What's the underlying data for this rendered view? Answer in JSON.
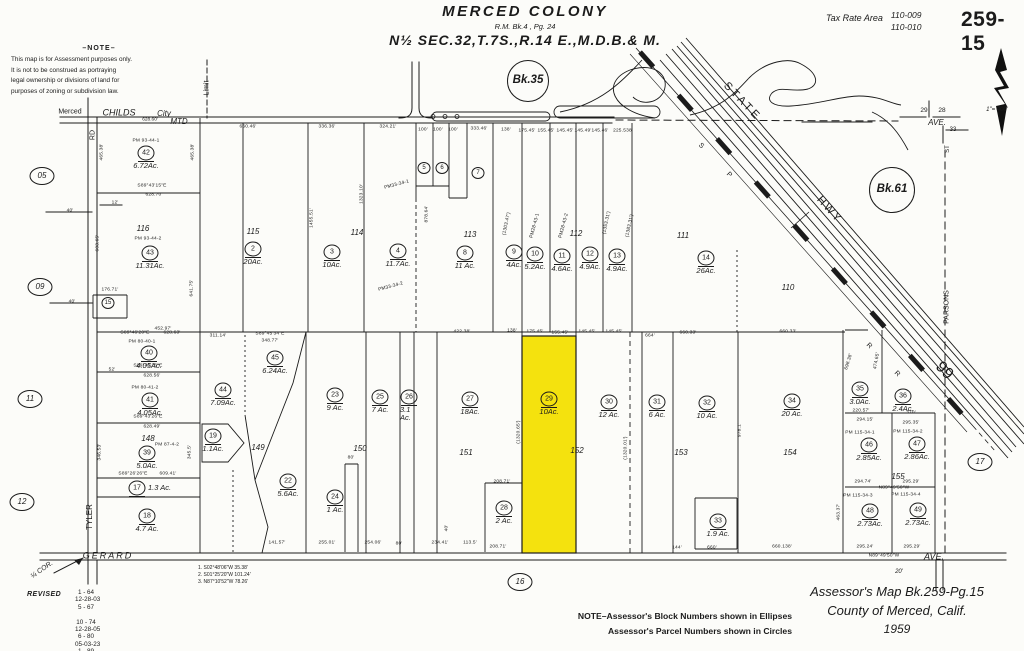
{
  "title": {
    "line1": "MERCED COLONY",
    "line2": "R.M. Bk.4 , Pg. 24",
    "line3": "N½ SEC.32,T.7S.,R.14 E.,M.D.B.& M."
  },
  "tax": {
    "label": "Tax Rate Area",
    "codes": [
      "110-009",
      "110-010"
    ]
  },
  "sheet_number": "259-15",
  "note_top_left": {
    "heading": "–NOTE–",
    "lines": [
      "This map is for Assessment purposes only.",
      "It is not to be construed as portraying",
      "legal ownership or divisions of land for",
      "purposes of zoning or subdivision law."
    ]
  },
  "legend_note": {
    "line1": "NOTE–Assessor's Block Numbers shown in Ellipses",
    "line2": "Assessor's Parcel Numbers shown in Circles"
  },
  "assessor_stamp": {
    "line1": "Assessor's Map Bk.259-Pg.15",
    "line2": "County of Merced, Calif.",
    "line3": "1959"
  },
  "revisions": {
    "label": "REVISED",
    "entries": [
      {
        "rev": "1 - 64",
        "date": "12-28-03"
      },
      {
        "rev": "5 - 67",
        "date": ""
      },
      {
        "rev": "10 - 74",
        "date": "12-28-05"
      },
      {
        "rev": "6 - 80",
        "date": "05-03-23"
      },
      {
        "rev": "1 - 89",
        "date": ""
      },
      {
        "rev": "11 - 91",
        "date": ""
      }
    ]
  },
  "bearing_table": [
    "1.  S02°48'06\"W   35.38'",
    "2.  S01°25'20\"W   101.24'",
    "3.  N87°10'52\"W   78.26'"
  ],
  "colors": {
    "highlight": "#F4E20E",
    "ink": "#1b1b1b",
    "paper": "#fcfcf9"
  },
  "parcels": [
    {
      "n": "42",
      "a": "6.72Ac.",
      "x": 146,
      "y": 153
    },
    {
      "n": "43",
      "a": "11.31Ac.",
      "x": 150,
      "y": 253
    },
    {
      "n": "15",
      "a": "",
      "x": 108,
      "y": 303,
      "small": true
    },
    {
      "n": "2",
      "a": "20Ac.",
      "x": 253,
      "y": 249
    },
    {
      "n": "3",
      "a": "10Ac.",
      "x": 332,
      "y": 252
    },
    {
      "n": "4",
      "a": "11.7Ac.",
      "x": 398,
      "y": 251
    },
    {
      "n": "5",
      "a": "",
      "x": 424,
      "y": 168,
      "small": true
    },
    {
      "n": "6",
      "a": "",
      "x": 442,
      "y": 168,
      "small": true
    },
    {
      "n": "7",
      "a": "",
      "x": 478,
      "y": 173,
      "small": true
    },
    {
      "n": "8",
      "a": "11 Ac.",
      "x": 465,
      "y": 253
    },
    {
      "n": "9",
      "a": "4Ac.",
      "x": 514,
      "y": 252
    },
    {
      "n": "10",
      "a": "5.2Ac.",
      "x": 535,
      "y": 254
    },
    {
      "n": "11",
      "a": "4.6Ac.",
      "x": 562,
      "y": 256
    },
    {
      "n": "12",
      "a": "4.9Ac.",
      "x": 590,
      "y": 254
    },
    {
      "n": "13",
      "a": "4.9Ac.",
      "x": 617,
      "y": 256
    },
    {
      "n": "14",
      "a": "26Ac.",
      "x": 706,
      "y": 258
    },
    {
      "n": "40",
      "a": "4.05Ac.",
      "x": 149,
      "y": 353
    },
    {
      "n": "41",
      "a": "4.05Ac.",
      "x": 150,
      "y": 400
    },
    {
      "n": "39",
      "a": "5.0Ac.",
      "x": 147,
      "y": 453
    },
    {
      "n": "45",
      "a": "6.24Ac.",
      "x": 275,
      "y": 358
    },
    {
      "n": "44",
      "a": "7.09Ac.",
      "x": 223,
      "y": 390
    },
    {
      "n": "19",
      "a": "1.1Ac.",
      "x": 213,
      "y": 436
    },
    {
      "n": "17",
      "a": "1.3 Ac.",
      "x": 137,
      "y": 488,
      "aside": true
    },
    {
      "n": "18",
      "a": "4.7 Ac.",
      "x": 147,
      "y": 516
    },
    {
      "n": "22",
      "a": "5.6Ac.",
      "x": 288,
      "y": 481
    },
    {
      "n": "23",
      "a": "9 Ac.",
      "x": 335,
      "y": 395
    },
    {
      "n": "24",
      "a": "1 Ac.",
      "x": 335,
      "y": 497
    },
    {
      "n": "25",
      "a": "7 Ac.",
      "x": 380,
      "y": 397
    },
    {
      "n": "26",
      "a": "3.1 Ac.",
      "x": 409,
      "y": 397,
      "wrap": true
    },
    {
      "n": "27",
      "a": "18Ac.",
      "x": 470,
      "y": 399
    },
    {
      "n": "28",
      "a": "2 Ac.",
      "x": 504,
      "y": 508
    },
    {
      "n": "29",
      "a": "10Ac.",
      "x": 549,
      "y": 399
    },
    {
      "n": "30",
      "a": "12 Ac.",
      "x": 609,
      "y": 402
    },
    {
      "n": "31",
      "a": "6 Ac.",
      "x": 657,
      "y": 402
    },
    {
      "n": "32",
      "a": "10 Ac.",
      "x": 707,
      "y": 403
    },
    {
      "n": "33",
      "a": "1.9 Ac.",
      "x": 718,
      "y": 521
    },
    {
      "n": "34",
      "a": "20 Ac.",
      "x": 792,
      "y": 401
    },
    {
      "n": "35",
      "a": "3.0Ac.",
      "x": 860,
      "y": 389
    },
    {
      "n": "36",
      "a": "2.4Ac.",
      "x": 903,
      "y": 396
    },
    {
      "n": "46",
      "a": "2.85Ac.",
      "x": 869,
      "y": 445
    },
    {
      "n": "47",
      "a": "2.86Ac.",
      "x": 917,
      "y": 444
    },
    {
      "n": "48",
      "a": "2.73Ac.",
      "x": 870,
      "y": 511
    },
    {
      "n": "49",
      "a": "2.73Ac.",
      "x": 918,
      "y": 510
    }
  ],
  "block_numbers": [
    {
      "t": "116",
      "x": 143,
      "y": 229
    },
    {
      "t": "115",
      "x": 253,
      "y": 232
    },
    {
      "t": "114",
      "x": 357,
      "y": 233
    },
    {
      "t": "113",
      "x": 470,
      "y": 235
    },
    {
      "t": "112",
      "x": 576,
      "y": 234
    },
    {
      "t": "111",
      "x": 683,
      "y": 236
    },
    {
      "t": "110",
      "x": 788,
      "y": 288
    },
    {
      "t": "148",
      "x": 148,
      "y": 439
    },
    {
      "t": "149",
      "x": 258,
      "y": 448
    },
    {
      "t": "150",
      "x": 360,
      "y": 449
    },
    {
      "t": "151",
      "x": 466,
      "y": 453
    },
    {
      "t": "152",
      "x": 577,
      "y": 451
    },
    {
      "t": "153",
      "x": 681,
      "y": 453
    },
    {
      "t": "154",
      "x": 790,
      "y": 453
    },
    {
      "t": "155",
      "x": 898,
      "y": 477
    }
  ],
  "block_ellipses": [
    {
      "t": "05",
      "x": 42,
      "y": 176
    },
    {
      "t": "09",
      "x": 40,
      "y": 287
    },
    {
      "t": "11",
      "x": 30,
      "y": 399
    },
    {
      "t": "12",
      "x": 22,
      "y": 502
    },
    {
      "t": "16",
      "x": 520,
      "y": 582
    },
    {
      "t": "17",
      "x": 980,
      "y": 462
    }
  ],
  "map_refs": [
    {
      "t": "Bk.35",
      "x": 528,
      "y": 81,
      "w": 40,
      "h": 40
    },
    {
      "t": "Bk.61",
      "x": 892,
      "y": 190,
      "w": 44,
      "h": 44
    }
  ],
  "road_labels": [
    {
      "t": "Merced",
      "x": 70,
      "y": 112,
      "s": 7,
      "nm": "merced-label"
    },
    {
      "t": "CHILDS",
      "x": 119,
      "y": 113,
      "s": 9,
      "i": 1,
      "nm": "childs-ave-label"
    },
    {
      "t": "City",
      "x": 164,
      "y": 114,
      "s": 8,
      "i": 1,
      "nm": "city-label"
    },
    {
      "t": "628.60'",
      "x": 150,
      "y": 121,
      "s": 4.8,
      "nm": "dim-childs"
    },
    {
      "t": "MTD",
      "x": 179,
      "y": 122,
      "s": 8,
      "i": 1,
      "nm": "mtd-label"
    },
    {
      "t": "Limit",
      "x": 207,
      "y": 88,
      "s": 7,
      "r": -90,
      "nm": "city-limit-label"
    },
    {
      "t": "RD",
      "x": 93,
      "y": 135,
      "s": 7,
      "r": -90,
      "nm": "rd-label"
    },
    {
      "t": "TYLER",
      "x": 90,
      "y": 517,
      "s": 8,
      "r": -90,
      "nm": "tyler-rd-label"
    },
    {
      "t": "GERARD",
      "x": 108,
      "y": 556,
      "s": 9,
      "ls": 2,
      "i": 1,
      "nm": "gerard-ave-label"
    },
    {
      "t": "AVE.",
      "x": 937,
      "y": 123,
      "s": 8,
      "i": 1,
      "nm": "ave-label-top"
    },
    {
      "t": "29",
      "x": 924,
      "y": 111,
      "s": 6.5,
      "nm": "section-number-label"
    },
    {
      "t": "28",
      "x": 942,
      "y": 111,
      "s": 6.5,
      "nm": "section-number-label"
    },
    {
      "t": "33",
      "x": 953,
      "y": 130,
      "s": 6,
      "nm": "section-number-label"
    },
    {
      "t": "ST",
      "x": 948,
      "y": 149,
      "s": 6,
      "r": -90,
      "nm": "st-label"
    },
    {
      "t": "PARSONS",
      "x": 947,
      "y": 307,
      "s": 7,
      "r": -90,
      "nm": "parsons-st-label"
    },
    {
      "t": "AVE.",
      "x": 934,
      "y": 557,
      "s": 9,
      "i": 1,
      "nm": "ave-label-bottom"
    },
    {
      "t": "20'",
      "x": 899,
      "y": 572,
      "s": 6,
      "i": 1,
      "nm": "dim-20ft"
    },
    {
      "t": "STATE",
      "x": 742,
      "y": 102,
      "s": 11,
      "r": 46,
      "ls": 3,
      "nm": "state-hwy-label-state"
    },
    {
      "t": "HWY",
      "x": 829,
      "y": 210,
      "s": 11,
      "r": 48,
      "ls": 2,
      "nm": "state-hwy-label-hwy"
    },
    {
      "t": "99",
      "x": 944,
      "y": 371,
      "s": 16,
      "r": 45,
      "nm": "state-hwy-label-99"
    },
    {
      "t": "S",
      "x": 701,
      "y": 146,
      "s": 7,
      "r": 45,
      "nm": "railroad-letter"
    },
    {
      "t": "P",
      "x": 729,
      "y": 175,
      "s": 7,
      "r": 45,
      "nm": "railroad-letter"
    },
    {
      "t": "R",
      "x": 869,
      "y": 346,
      "s": 7,
      "r": 45,
      "nm": "railroad-letter"
    },
    {
      "t": "R",
      "x": 897,
      "y": 374,
      "s": 7,
      "r": 45,
      "nm": "railroad-letter"
    },
    {
      "t": "¼ COR.",
      "x": 42,
      "y": 570,
      "s": 7,
      "r": -35,
      "i": 1,
      "nm": "quarter-corner-label"
    },
    {
      "t": "1\"= 400'",
      "x": 997,
      "y": 110,
      "s": 6,
      "i": 1,
      "nm": "scale-label"
    }
  ],
  "dimensions": [
    {
      "t": "660.46'",
      "x": 248,
      "y": 128
    },
    {
      "t": "336.36'",
      "x": 327,
      "y": 128
    },
    {
      "t": "324.21'",
      "x": 388,
      "y": 128
    },
    {
      "t": "100'",
      "x": 423,
      "y": 131
    },
    {
      "t": "100'",
      "x": 438,
      "y": 131
    },
    {
      "t": "100'",
      "x": 453,
      "y": 131
    },
    {
      "t": "333.46'",
      "x": 479,
      "y": 130
    },
    {
      "t": "138'",
      "x": 506,
      "y": 131
    },
    {
      "t": "175.45'",
      "x": 527,
      "y": 132
    },
    {
      "t": "155.45'",
      "x": 546,
      "y": 132
    },
    {
      "t": "145.45'",
      "x": 565,
      "y": 132
    },
    {
      "t": "145.49'",
      "x": 583,
      "y": 132
    },
    {
      "t": "145.46'",
      "x": 600,
      "y": 132
    },
    {
      "t": "225.538'",
      "x": 623,
      "y": 132
    },
    {
      "t": "465.38'",
      "x": 103,
      "y": 152,
      "r": -90
    },
    {
      "t": "465.38'",
      "x": 194,
      "y": 152,
      "r": -90
    },
    {
      "t": "603.65'",
      "x": 99,
      "y": 243,
      "r": -90
    },
    {
      "t": "641.75'",
      "x": 193,
      "y": 288,
      "r": -90
    },
    {
      "t": "S89°43'15\"E",
      "x": 152,
      "y": 187
    },
    {
      "t": "628.70'",
      "x": 154,
      "y": 196
    },
    {
      "t": "PM 93-44-1",
      "x": 146,
      "y": 142
    },
    {
      "t": "PM 93-44-2",
      "x": 148,
      "y": 240
    },
    {
      "t": "176.71'",
      "x": 110,
      "y": 291
    },
    {
      "t": "40'",
      "x": 72,
      "y": 303
    },
    {
      "t": "40'",
      "x": 70,
      "y": 212
    },
    {
      "t": "12'",
      "x": 115,
      "y": 204
    },
    {
      "t": "1455.51'",
      "x": 313,
      "y": 218,
      "r": -90
    },
    {
      "t": "1323.10'",
      "x": 363,
      "y": 194,
      "r": -90
    },
    {
      "t": "878.64'",
      "x": 428,
      "y": 214,
      "r": -90
    },
    {
      "t": "PM33-34-1",
      "x": 397,
      "y": 186,
      "r": -15
    },
    {
      "t": "PM33-34-2",
      "x": 391,
      "y": 288,
      "r": -15
    },
    {
      "t": "(1303.47')",
      "x": 508,
      "y": 224,
      "r": -78
    },
    {
      "t": "PM28-43-1",
      "x": 536,
      "y": 226,
      "r": -75
    },
    {
      "t": "PM28-43-2",
      "x": 565,
      "y": 226,
      "r": -75
    },
    {
      "t": "(1353.31')",
      "x": 608,
      "y": 223,
      "r": -78
    },
    {
      "t": "(1383.31')",
      "x": 631,
      "y": 226,
      "r": -78
    },
    {
      "t": "452.97'",
      "x": 163,
      "y": 330
    },
    {
      "t": "311.14'",
      "x": 218,
      "y": 337
    },
    {
      "t": "S89°45'34\"E",
      "x": 270,
      "y": 335
    },
    {
      "t": "348.77'",
      "x": 270,
      "y": 342
    },
    {
      "t": "422.38'",
      "x": 462,
      "y": 333
    },
    {
      "t": "138'",
      "x": 512,
      "y": 332
    },
    {
      "t": "175.45'",
      "x": 535,
      "y": 333
    },
    {
      "t": "155.45'",
      "x": 560,
      "y": 334
    },
    {
      "t": "145.45'",
      "x": 587,
      "y": 333
    },
    {
      "t": "145.45'",
      "x": 614,
      "y": 333
    },
    {
      "t": "664'",
      "x": 650,
      "y": 337
    },
    {
      "t": "660.33'",
      "x": 688,
      "y": 334
    },
    {
      "t": "660.33'",
      "x": 788,
      "y": 333
    },
    {
      "t": "S89°46'20\"E",
      "x": 135,
      "y": 334
    },
    {
      "t": "628.63'",
      "x": 172,
      "y": 334
    },
    {
      "t": "S89°45'26\"E",
      "x": 148,
      "y": 367
    },
    {
      "t": "628.56'",
      "x": 152,
      "y": 377
    },
    {
      "t": "S89°43'26\"E",
      "x": 148,
      "y": 418
    },
    {
      "t": "628.49'",
      "x": 152,
      "y": 428
    },
    {
      "t": "S89°26'26\"E",
      "x": 133,
      "y": 475
    },
    {
      "t": "609.41'",
      "x": 168,
      "y": 475
    },
    {
      "t": "52'",
      "x": 112,
      "y": 371
    },
    {
      "t": "346.53'",
      "x": 101,
      "y": 452,
      "r": -90
    },
    {
      "t": "345.5'",
      "x": 191,
      "y": 452,
      "r": -90
    },
    {
      "t": "698.38'",
      "x": 850,
      "y": 362,
      "r": -73
    },
    {
      "t": "474.65'",
      "x": 878,
      "y": 361,
      "r": -80
    },
    {
      "t": "220.57'",
      "x": 861,
      "y": 412
    },
    {
      "t": "370'",
      "x": 911,
      "y": 414
    },
    {
      "t": "294.15'",
      "x": 865,
      "y": 421
    },
    {
      "t": "295.35'",
      "x": 911,
      "y": 424
    },
    {
      "t": "PM 115-34-1",
      "x": 860,
      "y": 434
    },
    {
      "t": "PM 115-34-2",
      "x": 908,
      "y": 433
    },
    {
      "t": "294.74'",
      "x": 863,
      "y": 483
    },
    {
      "t": "295.29'",
      "x": 911,
      "y": 483
    },
    {
      "t": "N89°49'50\"W",
      "x": 894,
      "y": 489
    },
    {
      "t": "PM 115-34-3",
      "x": 858,
      "y": 497
    },
    {
      "t": "PM 115-34-4",
      "x": 906,
      "y": 496
    },
    {
      "t": "463.37'",
      "x": 840,
      "y": 512,
      "r": -90
    },
    {
      "t": "295.24'",
      "x": 865,
      "y": 548
    },
    {
      "t": "295.29'",
      "x": 912,
      "y": 548
    },
    {
      "t": "N89°49'50\"W",
      "x": 884,
      "y": 557
    },
    {
      "t": "141.57'",
      "x": 277,
      "y": 544
    },
    {
      "t": "255.01'",
      "x": 327,
      "y": 544
    },
    {
      "t": "254.06'",
      "x": 373,
      "y": 544
    },
    {
      "t": "80'",
      "x": 399,
      "y": 545
    },
    {
      "t": "234.41'",
      "x": 440,
      "y": 544
    },
    {
      "t": "113.5'",
      "x": 470,
      "y": 544
    },
    {
      "t": "208.71'",
      "x": 502,
      "y": 483
    },
    {
      "t": "208.71'",
      "x": 498,
      "y": 548
    },
    {
      "t": "40'",
      "x": 448,
      "y": 528,
      "r": -90
    },
    {
      "t": "(1320.65')",
      "x": 520,
      "y": 432,
      "r": -90
    },
    {
      "t": "(1320.01')",
      "x": 627,
      "y": 448,
      "r": -90
    },
    {
      "t": "978.1'",
      "x": 741,
      "y": 430,
      "r": -90
    },
    {
      "t": "80'",
      "x": 351,
      "y": 459
    },
    {
      "t": "144'",
      "x": 677,
      "y": 549
    },
    {
      "t": "660'",
      "x": 712,
      "y": 549
    },
    {
      "t": "660.138'",
      "x": 782,
      "y": 548
    },
    {
      "t": "PM 80-40-1",
      "x": 142,
      "y": 343
    },
    {
      "t": "PM 80-41-2",
      "x": 145,
      "y": 389
    },
    {
      "t": "PM 87-4-2",
      "x": 167,
      "y": 446
    }
  ]
}
